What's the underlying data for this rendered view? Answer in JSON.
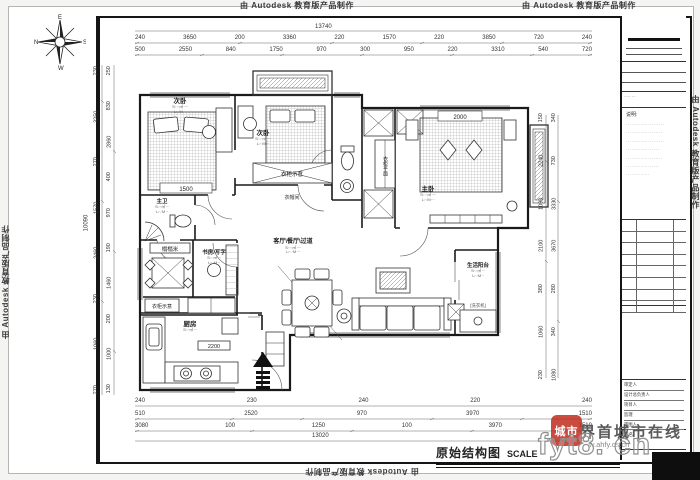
{
  "watermark": {
    "autodesk": "由 Autodesk 教育版产品制作"
  },
  "compass": {
    "top": "E",
    "left": "N",
    "right": "S",
    "bottom": "W"
  },
  "plan": {
    "rooms": {
      "bedroom1": {
        "name": "次卧",
        "note1": "S:··.·㎡ ····",
        "note2": "L:·.·M ···",
        "bed_dim": "1500"
      },
      "bedroom2": {
        "name": "次卧",
        "note1": "S:··.·㎡ ····",
        "note2": "L:·.·M ···"
      },
      "master": {
        "name": "主卧",
        "note1": "S:··.·㎡ ····",
        "note2": "L:·.·M ···",
        "bed_dim": "2000"
      },
      "bath": {
        "name": "主卫",
        "note1": "S:·.·㎡ ···",
        "note2": "L:·.·M ··"
      },
      "tatami": {
        "name": "榻榻米"
      },
      "study": {
        "name": "书房/写字",
        "note1": "S:·.·㎡ ···",
        "note2": "L:·.·M ··"
      },
      "cloak": {
        "name": "衣帽间"
      },
      "kitchen": {
        "name": "厨房",
        "note1": "S:·.·㎡ ···",
        "note2": "L:·.·M ··",
        "dim": "2200"
      },
      "living": {
        "name": "客厅\\餐厅\\过道",
        "note1": "S:··.·㎡ ····",
        "note2": "L:··.·M ···"
      },
      "balcony": {
        "name": "生活阳台",
        "note1": "S:·.·㎡ ···",
        "note2": "L:·.·M ··",
        "appliance": "(洗衣机)"
      },
      "wardrobe_label": "衣柜示意",
      "closet_label": "衣柜平面"
    },
    "dims": {
      "top_total": "13740",
      "top_row1": [
        "240",
        "3650",
        "200",
        "3360",
        "220",
        "1570",
        "220",
        "3850",
        "720",
        "240"
      ],
      "top_row2": [
        "500",
        "2550",
        "840",
        "1750",
        "970",
        "300",
        "950",
        "220",
        "3310",
        "540",
        "720"
      ],
      "bottom_row1": [
        "240",
        "230",
        "240",
        "220",
        "240"
      ],
      "bottom_row2": [
        "510",
        "2520",
        "970",
        "3970",
        "1510"
      ],
      "bottom_row3": [
        "3080",
        "100",
        "1250",
        "100",
        "3970",
        "1510"
      ],
      "bottom_total": "13020",
      "left_outer": [
        "230",
        "3250",
        "270",
        "1570",
        "2460",
        "230",
        "1060",
        "270"
      ],
      "left_inner": [
        "250",
        "830",
        "2860",
        "400",
        "970",
        "190",
        "1460",
        "200",
        "1000",
        "130"
      ],
      "left_total": "10090",
      "right_col1": [
        "150",
        "2240",
        "1090",
        "2100",
        "380",
        "1060",
        "230"
      ],
      "right_col2": [
        "340",
        "730",
        "3330",
        "3670",
        "280",
        "340",
        "1080"
      ]
    }
  },
  "title_block": {
    "field_note": "····· ···",
    "note_heading": "说明:",
    "note_lines": [
      "·····················",
      "····················",
      "·····················",
      "···················",
      "····················",
      "··················",
      "·············"
    ],
    "people": [
      "审定人",
      "设计总负责人",
      "项目人",
      "监理",
      "审图人"
    ],
    "drawing_name_label": "图名",
    "bottom_note": "·· ···· · ·· ··"
  },
  "footer": {
    "drawing_title": "原始结构图",
    "scale_label": "SCALE"
  },
  "overlay": {
    "seal": "城市",
    "site_name": "界首城市在线",
    "url": "w.ahfy.cs.cn",
    "domain": "fyt8. cn"
  }
}
